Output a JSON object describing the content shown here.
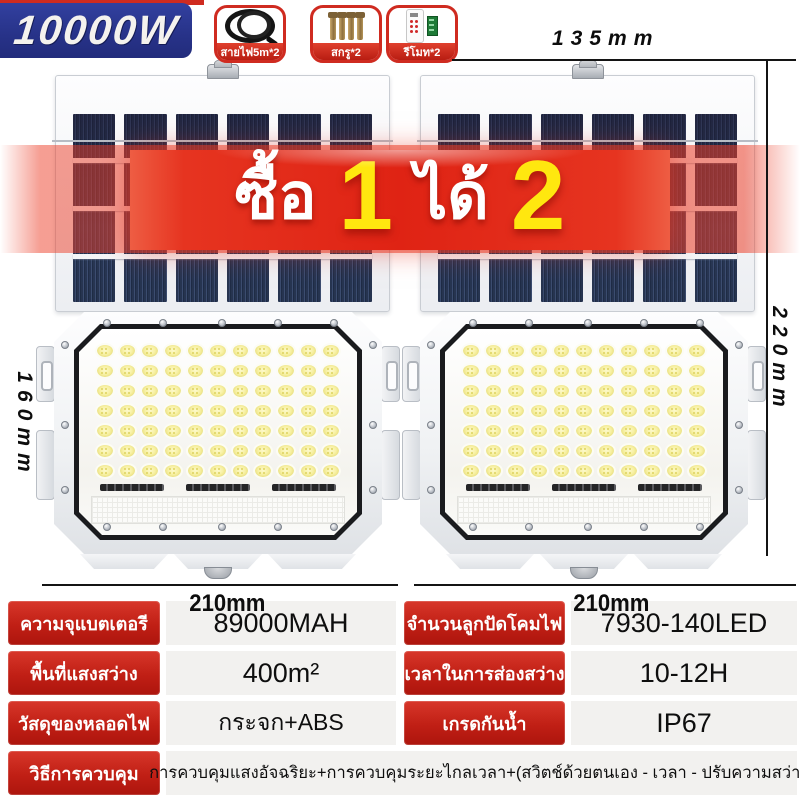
{
  "badge": {
    "wattage": "10000W"
  },
  "accessories": [
    {
      "name": "power-cable",
      "label": "สายไฟ5m*2"
    },
    {
      "name": "screws",
      "label": "สกรู*2"
    },
    {
      "name": "remote-control",
      "label": "รีโมท*2"
    }
  ],
  "promo_banner": {
    "word_buy": "ซื้อ",
    "qty_buy": "1",
    "word_get": "ได้",
    "qty_get": "2"
  },
  "dimensions": {
    "panel_width": "135mm",
    "panel_height": "220mm",
    "lamp_height": "160mm",
    "lamp_width_left": "210mm",
    "lamp_width_right": "210mm"
  },
  "spec_table": {
    "rows": [
      {
        "label": "ความจุแบตเตอรี",
        "value": "89000MAH"
      },
      {
        "label": "จำนวนลูกปัดโคมไฟ",
        "value": "7930-140LED"
      },
      {
        "label": "พื้นที่แสงสว่าง",
        "value": "400m²"
      },
      {
        "label": "เวลาในการส่องสว่าง",
        "value": "10-12H"
      },
      {
        "label": "วัสดุของหลอดไฟ",
        "value": "กระจก+ABS"
      },
      {
        "label": "เกรดกันน้ำ",
        "value": "IP67"
      },
      {
        "label": "วิธีการควบคุม",
        "value": "การควบคุมแสงอัจฉริยะ+การควบคุมระยะไกลเวลา+(สวิตช์ด้วยตนเอง - เวลา - ปรับความสว่าง)"
      }
    ]
  },
  "colors": {
    "accent_red": "#cf2b20",
    "badge_blue": "#273288",
    "number_yellow": "#ffe70f",
    "value_cell_bg": "#f2f1ef"
  }
}
